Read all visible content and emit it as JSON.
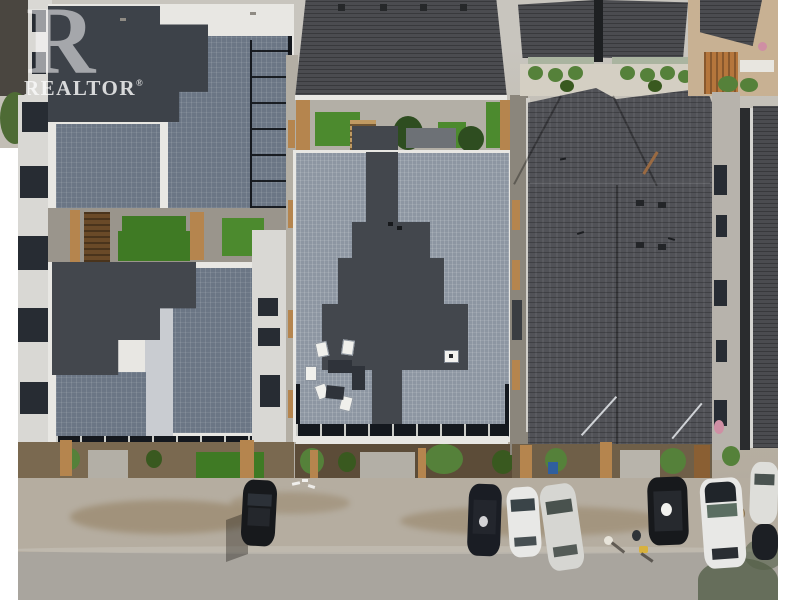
{
  "watermark": {
    "logo_letter": "R",
    "text": "REALTOR",
    "registered": "®"
  },
  "colors": {
    "margin_white": "#ffffff",
    "pavement": "#c8c5be",
    "ground_mid": "#b8b2a6",
    "gravel": "#b5ada0",
    "road": "#a9a59e",
    "dirt_patch": "#8a7350",
    "roof_dark_flat": "#3d4249",
    "roof_blue_gray": "#6b7685",
    "roof_light_gray": "#8d96a2",
    "roof_cross_dark": "#43474d",
    "shingle_dark": "#4b4c50",
    "shingle_mid": "#515257",
    "parapet_white": "#e8e7e3",
    "facade_white": "#d9d8d4",
    "facade_gray": "#b7b3ac",
    "window_dark": "#272c33",
    "frame_black": "#14181e",
    "grass_green": "#3f7a24",
    "turf_green": "#4c8a2e",
    "bush_green": "#55813a",
    "bush_dark": "#39591f",
    "tree_dark": "#2e4d20",
    "wood_tan": "#b5854e",
    "wood_dark": "#6a4a28",
    "wood_orange": "#b5763c",
    "soil_brown": "#5c4c38",
    "concrete": "#b3afa6",
    "awning_sage": "#aab4a0",
    "tan_wall": "#c8b193",
    "car_black": "#17191c",
    "car_navy": "#1a1d24",
    "car_white": "#e8e8e6",
    "car_silver": "#d6d6d2",
    "glint_white": "#f2f2ef",
    "tree_shadow": "#55604a",
    "bin_blue": "#2f5f9e",
    "bag_yellow": "#d8b23e",
    "flower_pink": "#cf8fa4"
  }
}
